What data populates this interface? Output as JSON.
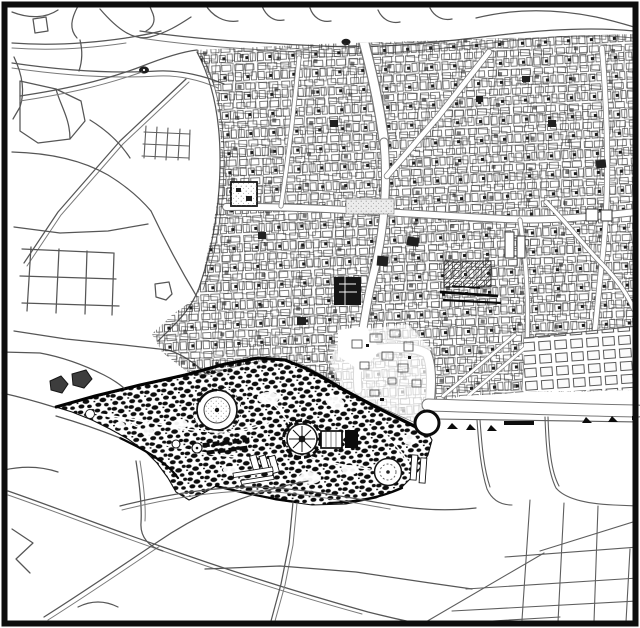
{
  "figure": {
    "type": "scanned-city-map",
    "style": "black-and-white figure-ground plan, no text labels visible",
    "text_labels": [],
    "colors": {
      "paper": "#ffffff",
      "frame": "#0d0d0d",
      "road_line": "#565656",
      "urban_line": "#3a3a3a",
      "dense_fill": "#0d0d0d"
    }
  },
  "regions": [
    {
      "name": "rural-northwest",
      "description": "sparse winding roads and rectangular field plots"
    },
    {
      "name": "dense-urban-fabric",
      "description": "fine-grained old-city building blocks covering the right half"
    },
    {
      "name": "gridded-district",
      "description": "regular rectangular block grid at middle right"
    },
    {
      "name": "landscaped-park",
      "description": "dark tree-covered park with circular ring, radial plaza, terraces"
    },
    {
      "name": "southeast-open-blocks",
      "description": "large empty blocks with small tree marks along a wide road"
    },
    {
      "name": "southern-road-network",
      "description": "diagonal crossing roads and a small street grid at bottom right"
    }
  ],
  "features": [
    {
      "name": "main-north-south-street"
    },
    {
      "name": "east-west-street"
    },
    {
      "name": "diagonal-avenue-to-roundabout"
    },
    {
      "name": "park-circular-ring"
    },
    {
      "name": "park-radial-plaza"
    },
    {
      "name": "park-white-circle"
    },
    {
      "name": "roundabout"
    },
    {
      "name": "walled-compound"
    },
    {
      "name": "hatched-building"
    },
    {
      "name": "dark-building"
    }
  ]
}
